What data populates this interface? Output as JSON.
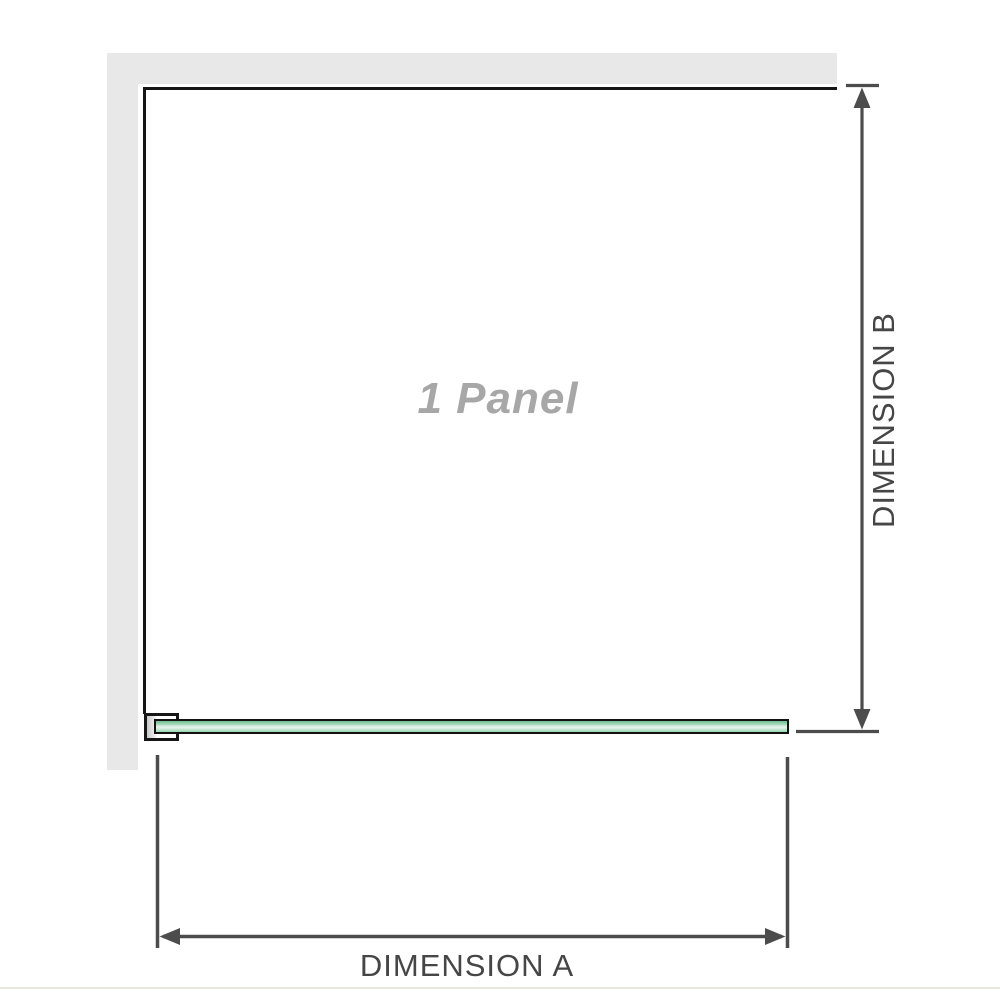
{
  "diagram": {
    "panel_label": "1 Panel",
    "dimensions": {
      "horizontal": {
        "label": "DIMENSION A"
      },
      "vertical": {
        "label": "DIMENSION B"
      }
    },
    "colors": {
      "wall_gray": "#e8e8e8",
      "outline_black": "#161616",
      "dimension_line_gray": "#4c4c4c",
      "dimension_label_gray": "#464646",
      "panel_label_gray": "#a7a7a7",
      "glass_green_edge": "#6fbd92",
      "glass_green_center": "#e8f6ee",
      "divider_gray": "#eae7e1"
    }
  }
}
